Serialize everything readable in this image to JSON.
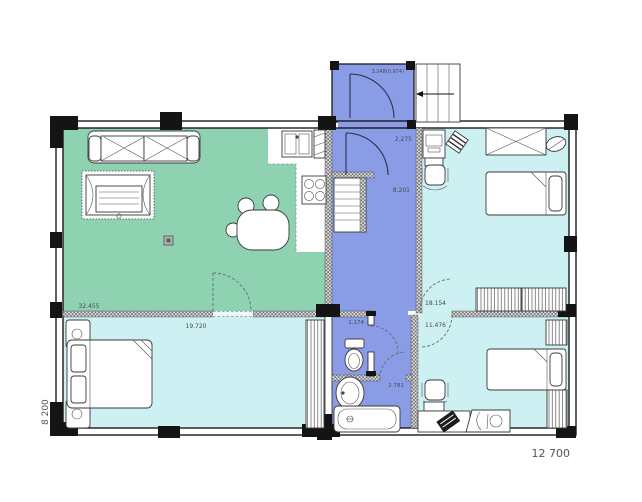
{
  "plan": {
    "rooms": {
      "porch": {
        "area_label": "3.248(0.974)"
      },
      "entry_hall": {
        "area_label": "2.275"
      },
      "hallway": {
        "area_label": "8.201"
      },
      "living": {
        "area_label": "32.455"
      },
      "bedroom_left": {
        "area_label": "19.720"
      },
      "bedroom_top_right": {
        "area_label": "18.154"
      },
      "bedroom_bottom_right": {
        "area_label": "11.476"
      },
      "wc": {
        "area_label": "1.174"
      },
      "bathroom": {
        "area_label": "2.781"
      }
    },
    "dimensions": {
      "height_mm": "8 200",
      "width_mm": "12 700"
    },
    "colors": {
      "living_green": "#8ed2b2",
      "bedroom_cyan": "#cdf0f3",
      "hall_blue": "#8b9ce6",
      "wall_black": "#141414",
      "label_gray": "#4a4a4a"
    }
  }
}
